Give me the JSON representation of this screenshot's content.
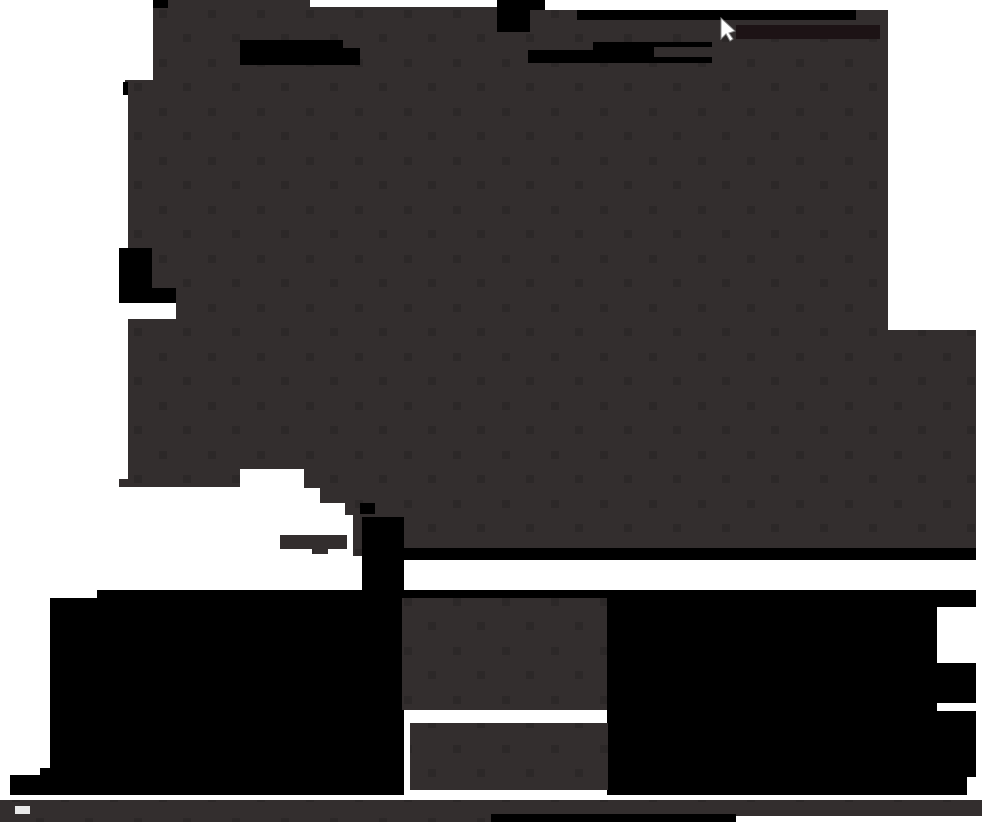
{
  "canvas": {
    "width": 982,
    "height": 822
  },
  "colors": {
    "background": "#ffffff",
    "blob_gray": "#332e2e",
    "blob_gray_dot": "#2c2828",
    "black": "#000000",
    "near_black_red": "#1d1315",
    "cursor_white": "#ffffff",
    "cursor_shadow": "#8a8a8a",
    "bar_gray": "#332e2e",
    "notch_white": "#e9e9e9"
  },
  "scene": {
    "description": "Dark screen capture: large dark-gray silhouette blob with black patches on white background, mouse cursor visible near top, black masses and gray blocks in lower third, gray bar across the bottom.",
    "cursor": {
      "x": 721,
      "y": 18,
      "visible": true
    },
    "text_content": "none"
  }
}
